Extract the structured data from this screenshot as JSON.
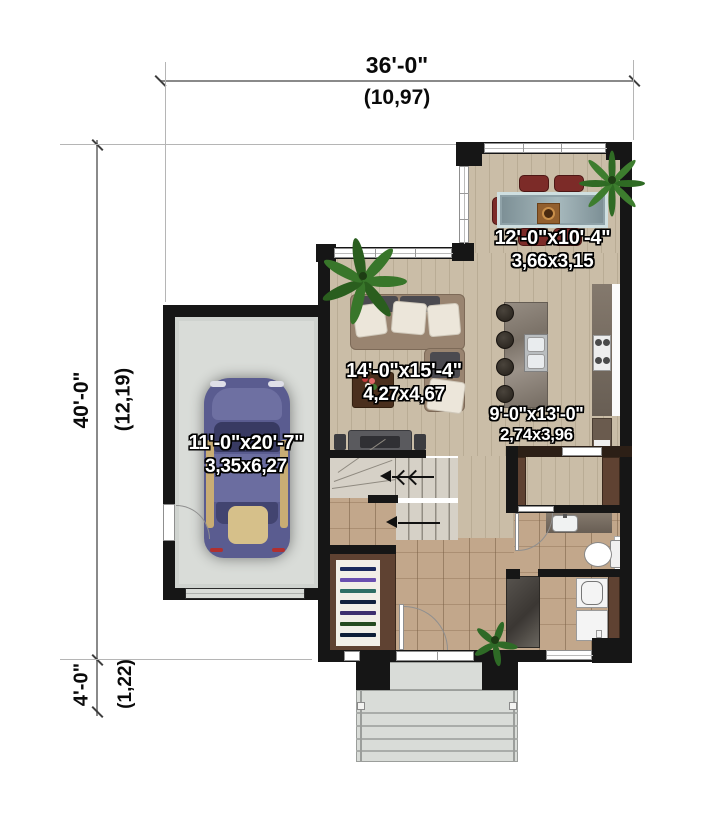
{
  "dimensions": {
    "width_total": {
      "imperial": "36'-0\"",
      "metric": "(10,97)"
    },
    "height_total": {
      "imperial": "40'-0\"",
      "metric": "(12,19)"
    },
    "porch_depth": {
      "imperial": "4'-0\"",
      "metric": "(1,22)"
    }
  },
  "rooms": {
    "garage": {
      "imperial": "11'-0\"x20'-7\"",
      "metric": "3,35x6,27"
    },
    "living": {
      "imperial": "14'-0\"x15'-4\"",
      "metric": "4,27x4,67"
    },
    "dining": {
      "imperial": "12'-0\"x10'-4\"",
      "metric": "3,66x3,15"
    },
    "kitchen": {
      "imperial": "9'-0\"x13'-0\"",
      "metric": "2,74x3,96"
    }
  },
  "colors": {
    "wall": "#161616",
    "wood_floor": "#c8bca6",
    "tile_floor": "#bfa287",
    "concrete": "#d9dcd8",
    "label_text": "#ffffff",
    "dimension_text": "#0a0a0a",
    "dining_chair": "#7c2b28",
    "car_body": "#5a5c90",
    "plant": "#3c772b",
    "closet_wood": "#5d4130",
    "shower": "#4e4a46"
  }
}
